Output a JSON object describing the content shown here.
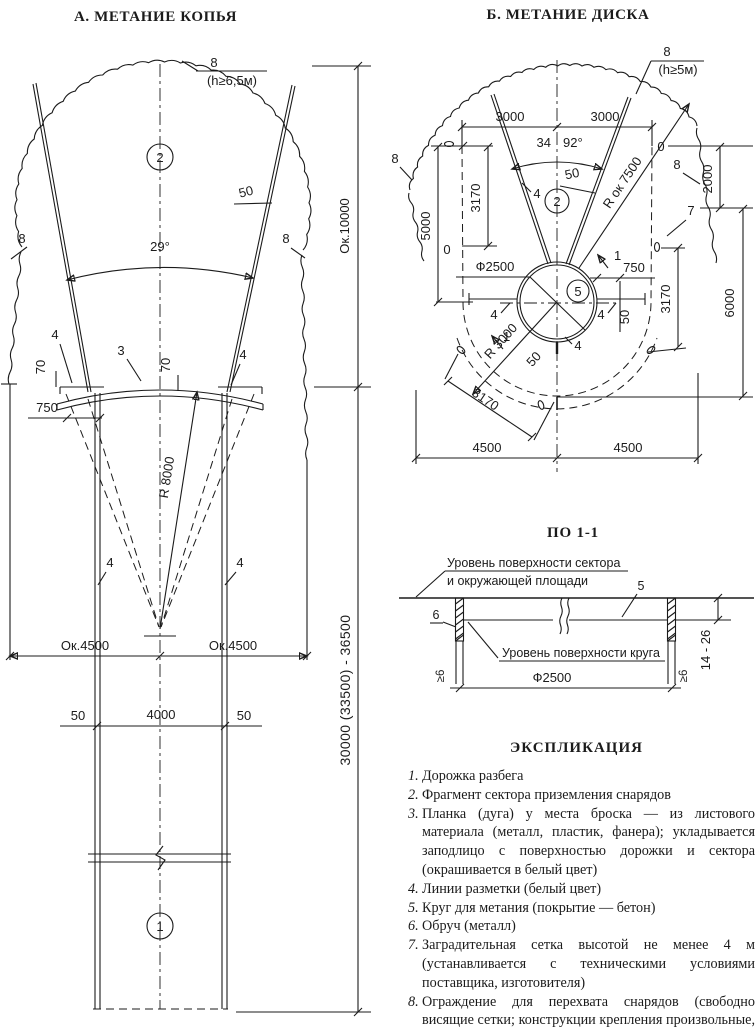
{
  "titles": {
    "a": "А. МЕТАНИЕ КОПЬЯ",
    "b": "Б. МЕТАНИЕ ДИСКА"
  },
  "a": {
    "n8": "8",
    "h": "(h≥6,5м)",
    "c2": "2",
    "c1": "1",
    "deg": "29°",
    "n50": "50",
    "n4": "4",
    "n3": "3",
    "n70": "70",
    "n750": "750",
    "r8000": "R 8000",
    "ok4500": "Ок.4500",
    "n4000": "4000",
    "ok10000": "Ок.10000",
    "long": "30000 (33500) - 36500"
  },
  "b": {
    "n3000": "3000",
    "a_l": "34",
    "a_r": "92°",
    "n8": "8",
    "h": "(h≥5м)",
    "n50": "50",
    "rok": "R ок 7500",
    "n0": "0",
    "n5000": "5000",
    "n3170": "3170",
    "n2000": "2000",
    "n6000": "6000",
    "n4500": "4500",
    "d2500": "Ф2500",
    "r3000": "R 3000",
    "n750": "750",
    "n4": "4",
    "n7": "7",
    "n1": "1",
    "c2": "2",
    "c5": "5"
  },
  "section": {
    "title": "ПО 1-1",
    "l1": "Уровень поверхности сектора",
    "l2": "и окружающей площади",
    "l3": "Уровень поверхности круга",
    "n5": "5",
    "n6": "6",
    "d2500": "Ф2500",
    "ge6": "≥6",
    "range": "14 - 26"
  },
  "explication": {
    "title": "ЭКСПЛИКАЦИЯ",
    "items": [
      {
        "num": "1.",
        "text": "Дорожка разбега"
      },
      {
        "num": "2.",
        "text": "Фрагмент сектора приземления снарядов"
      },
      {
        "num": "3.",
        "text": "Планка (дуга) у места броска — из листового материала (металл, пластик, фанера); укладывается заподлицо с поверхностью дорожки и сектора (окрашивается в белый цвет)"
      },
      {
        "num": "4.",
        "text": "Линии разметки (белый цвет)"
      },
      {
        "num": "5.",
        "text": "Круг для метания (покрытие — бетон)"
      },
      {
        "num": "6.",
        "text": "Обруч (металл)"
      },
      {
        "num": "7.",
        "text": "Заградительная сетка высотой не менее 4 м (устанавливается с техническими условиями поставщика, изготовителя)"
      },
      {
        "num": "8.",
        "text": "Ограждение для перехвата снарядов (свободно висящие сетки; конструкции крепления произвольные, выполняются по месту)"
      }
    ]
  }
}
